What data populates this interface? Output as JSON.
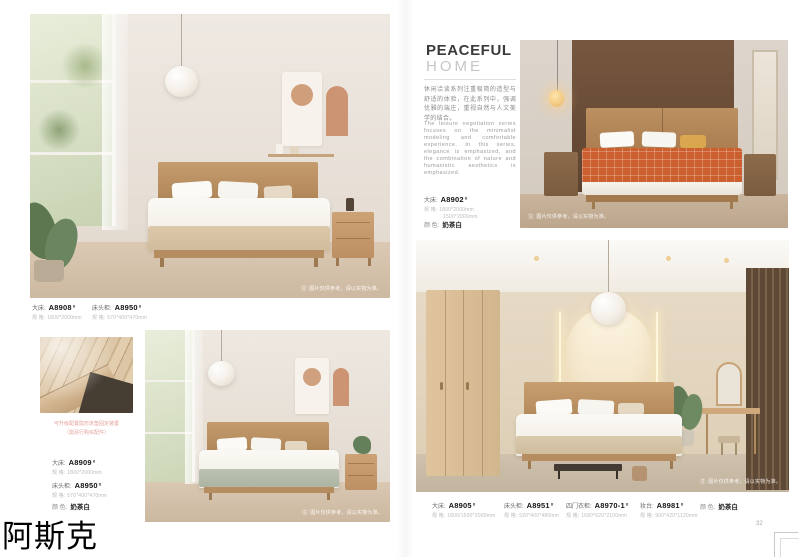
{
  "shared": {
    "photo_note": "注: 图片仅供参考，请以实物为准。"
  },
  "watermark": "阿斯克",
  "left_page": {
    "page_number": "31",
    "top_products": [
      {
        "type": "大床:",
        "code": "A8908",
        "sup": "#",
        "spec_label": "规 格:",
        "spec": "1800*2000mm"
      },
      {
        "type": "床头柜:",
        "code": "A8950",
        "sup": "#",
        "spec_label": "规 格:",
        "spec": "570*400*470mm"
      }
    ],
    "detail_caption_1": "可升级配置隐形床垫固定装置",
    "detail_caption_2": "（需另行购买配件）",
    "bottom_products": [
      {
        "type": "大床:",
        "code": "A8909",
        "sup": "#",
        "spec_label": "规 格:",
        "spec": "1800*2000mm"
      },
      {
        "type": "床头柜:",
        "code": "A8950",
        "sup": "#",
        "spec_label": "规 格:",
        "spec": "570*400*470mm"
      }
    ],
    "color_label": "颜 色:",
    "color_value": "奶茶白"
  },
  "right_page": {
    "page_number": "32",
    "title_line1": "PEACEFUL",
    "title_line2": "HOME",
    "desc_cn": "休闲洽谈系列注重极简的造型与舒适的体验，在此系列中，强调优雅的端庄，重视自然与人文美学的结合。",
    "desc_en": "The leisure negotiation series focuses on the minimalist modeling and comfortable experience. In this series, elegance is emphasized, and the combination of nature and humanistic aesthetics is emphasized.",
    "hero": {
      "type": "大床:",
      "code": "A8902",
      "sup": "#",
      "spec_label": "规 格:",
      "spec_line1": "1800*2000mm",
      "spec_line2": "1500*2000mm",
      "color_label": "颜 色:",
      "color_value": "奶茶白"
    },
    "bottom_products": [
      {
        "type": "大床:",
        "code": "A8905",
        "sup": "#",
        "spec_label": "规 格:",
        "spec": "1800/1500*2000mm"
      },
      {
        "type": "床头柜:",
        "code": "A8951",
        "sup": "#",
        "spec_label": "规 格:",
        "spec": "520*400*480mm"
      },
      {
        "type": "四门衣柜:",
        "code": "A8970-1",
        "sup": "#",
        "spec_label": "规 格:",
        "spec": "1680*620*2100mm"
      },
      {
        "type": "妆台:",
        "code": "A8981",
        "sup": "#",
        "spec_label": "规 格:",
        "spec": "900*420*1120mm"
      }
    ],
    "color_label": "颜 色:",
    "color_value": "奶茶白"
  }
}
